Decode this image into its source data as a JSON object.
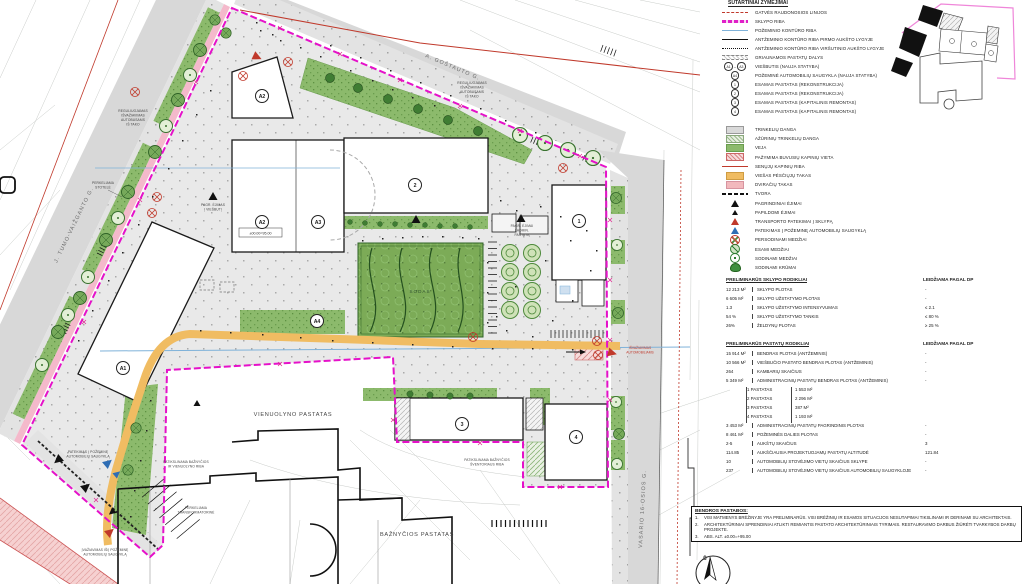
{
  "colors": {
    "site_boundary": "#e511c9",
    "street_red_line": "#c0392b",
    "underground_blue": "#7fb2d9",
    "lawn_green": "#8cba6c",
    "path_orange": "#f0bc62",
    "bike_pink": "#f4b9cb",
    "paving_gray": "#e3e3e3"
  },
  "plan": {
    "streets": {
      "gostauto": "A. GOŠTAUTO G.",
      "tumo_vaizganto": "J. TUMO-VAIŽGANTO G.",
      "vasario": "VASARIO 16-OSIOS G."
    },
    "areas": {
      "vienuolynas": "VIENUOLYNO PASTATAS",
      "baznycia": "BAŽNYČIOS PASTATAS",
      "sodas": "SODAS"
    },
    "elevation": "±00.00=95.00",
    "north": "Š",
    "badges": {
      "a1": "A1",
      "a2_upper": "A2",
      "a2": "A2",
      "a3": "A3",
      "a4": "A4",
      "b1": "1",
      "b2": "2",
      "b3": "3",
      "b4": "4"
    },
    "annotations": {
      "regul_top": [
        "REGULIUOJAMAS",
        "IŠVAŽIAVIMAS",
        "AUTOBUSAMS",
        "IŠ TAKO"
      ],
      "regul_left": [
        "REGULIUOJAMAS",
        "IŠVAŽIAVIMAS",
        "AUTOBUSAMS",
        "IŠ TAKO"
      ],
      "stotele": [
        "PERKELIAMA",
        "STOTELĖ"
      ],
      "pagr_viesbutis": [
        "PAGR. ĖJIMAS",
        "Į VIEŠBUTĮ"
      ],
      "pagr_admin": [
        "PAGR. ĖJIMAI",
        "Į ADMIN.",
        "PASTATĄ"
      ],
      "patekimas_pozemine": [
        "PATEKIMAS Į POŽEMINĘ",
        "AUTOMOBILIŲ SAUGYKLĄ"
      ],
      "isvaziavimas_pozemine": [
        "ĮVAŽIAVIMAS IŠ/Į POŽEMINĘ",
        "AUTOMOBILIŲ SAUGYKLĄ"
      ],
      "isvaziavimas_auto": [
        "IŠVAŽIAVIMAS",
        "AUTOMOBILIAMS"
      ],
      "patikslinama_riba": [
        "PATIKSLINAMA BAŽNYČIOS",
        "IR VIENUOLYNO RIBA"
      ],
      "transformatorine": [
        "PERKELIAMA",
        "TRANSFORMATORINĖ"
      ],
      "sventorius": [
        "PATIKSLINAMA BAŽNYČIOS",
        "ŠVENTORIAUS RIBA"
      ]
    }
  },
  "legend": {
    "title": "SUTARTINIAI ŽYMĖJIMAI",
    "lines": [
      {
        "sym": "line-red-dashed",
        "label": "GATVĖS RAUDONOSIOS LINIJOS"
      },
      {
        "sym": "line-magenta",
        "label": "SKLYPO RIBA"
      },
      {
        "sym": "line-blue",
        "label": "POŽEMINIO KONTŪRO RIBA"
      },
      {
        "sym": "line-black",
        "label": "ANTŽEMINIO KONTŪRO RIBA PIRMO AUKŠTO LYGYJE"
      },
      {
        "sym": "line-black-dotted",
        "label": "ANTŽEMINIO KONTŪRO RIBA VIRŠUTINIO AUKŠTO LYGYJE"
      },
      {
        "sym": "line-demolish",
        "label": "GRIAUNAMOS PASTATŲ DALYS"
      },
      {
        "sym": "badge-pair",
        "g1": "A1",
        "dash": "–",
        "g2": "A3",
        "label": "VIEŠBUTIS (NAUJA STATYBA)"
      },
      {
        "sym": "badge",
        "g1": "A4",
        "label": "POŽEMINĖ AUTOMOBILIŲ SAUGYKLA (NAUJA STATYBA)"
      },
      {
        "sym": "badge",
        "g1": "1",
        "label": "ESAMAS PASTATAS (REKONSTRUKCIJA)"
      },
      {
        "sym": "badge",
        "g1": "2",
        "label": "ESAMAS PASTATAS (REKONSTRUKCIJA)"
      },
      {
        "sym": "badge",
        "g1": "3",
        "label": "ESAMAS PASTATAS (KAPITALINIS REMONTAS)"
      },
      {
        "sym": "badge",
        "g1": "4",
        "label": "ESAMAS PASTATAS (KAPITALINIS REMONTAS)"
      }
    ],
    "surfaces": [
      {
        "sym": "swatch-gray",
        "label": "TRINKELIŲ DANGA"
      },
      {
        "sym": "swatch-perm",
        "label": "AŽŪRINIŲ TRINKELIŲ DANGA"
      },
      {
        "sym": "swatch-green",
        "label": "VEJA"
      },
      {
        "sym": "swatch-cemetery",
        "label": "PAŽYMIMA BUVUSIŲ KAPINIŲ VIETA"
      },
      {
        "sym": "line-red",
        "label": "SENŲJŲ KAPINIŲ RIBA"
      },
      {
        "sym": "swatch-orange",
        "label": "VIEŠAS PĖSČIŲJŲ TAKAS"
      },
      {
        "sym": "swatch-pink",
        "label": "DVIRAČIŲ TAKAS"
      },
      {
        "sym": "line-fence",
        "label": "TVORA"
      },
      {
        "sym": "tri-black",
        "label": "PAGRINDINIAI ĖJIMAI"
      },
      {
        "sym": "tri-black-small",
        "label": "PAPILDOMI ĖJIMAI"
      },
      {
        "sym": "tri-red",
        "label": "TRANSPORTO PATEKIMAI Į SKLYPĄ"
      },
      {
        "sym": "tri-blue",
        "label": "PATEKIMAS Į POŽEMINĘ AUTOMOBILIŲ SAUGYKLĄ"
      },
      {
        "sym": "tree-replant",
        "label": "PERSODINAMI MEDŽIAI"
      },
      {
        "sym": "tree-existing",
        "label": "ESAMI MEDŽIAI"
      },
      {
        "sym": "tree-new",
        "label": "SODINAMI MEDŽIAI"
      },
      {
        "sym": "shrub",
        "label": "SODINAMI KRŪMAI"
      }
    ]
  },
  "tables": {
    "site": {
      "title": "PRELIMINARŪS SKLYPO RODIKLIAI",
      "allowed_header": "LEIDŽIAMA PAGAL DP",
      "rows": [
        {
          "value": "12 213 M²",
          "label": "SKLYPO PLOTAS",
          "allowed": "-"
        },
        {
          "value": "6 605 M²",
          "label": "SKLYPO UŽSTATYMO PLOTAS",
          "allowed": "-"
        },
        {
          "value": "1.3",
          "label": "SKLYPO UŽSTATYMO INTENSYVUMAS",
          "allowed": "≤ 2.1"
        },
        {
          "value": "54 %",
          "label": "SKLYPO UŽSTATYMO TANKIS",
          "allowed": "≤ 80 %"
        },
        {
          "value": "26%",
          "label": "ŽELDYNŲ PLOTAS",
          "allowed": "≥ 25 %"
        }
      ]
    },
    "buildings": {
      "title": "PRELIMINARŪS PASTATŲ RODIKLIAI",
      "allowed_header": "LEIDŽIAMA PAGAL DP",
      "rows_top": [
        {
          "value": "15 914 M²",
          "label": "BENDRAS PLOTAS (ANTŽEMINIS)",
          "allowed": "-"
        },
        {
          "value": "10 566 M²",
          "label": "VIEŠBUČIO PASTATO BENDRAS PLOTAS (ANTŽEMINIS)",
          "allowed": "-"
        },
        {
          "value": "264",
          "label": "KAMBARIŲ SKAIČIUS",
          "allowed": "-"
        },
        {
          "value": "5 349 M²",
          "label": "ADMINISTRACINIŲ PASTATŲ BENDRAS PLOTAS (ANTŽEMINIS)",
          "allowed": "-"
        }
      ],
      "sub_rows": [
        {
          "label": "1 PASTATAS",
          "value": "1 553 M²"
        },
        {
          "label": "2 PASTATAS",
          "value": "2 296 M²"
        },
        {
          "label": "3 PASTATAS",
          "value": "387 M²"
        },
        {
          "label": "4 PASTATAS",
          "value": "1 193 M²"
        }
      ],
      "rows_bottom": [
        {
          "value": "3 453 M²",
          "label": "ADMINISTRACINIŲ PASTATŲ PAGRINDINIS PLOTAS",
          "allowed": "-"
        },
        {
          "value": "8 461 M²",
          "label": "POŽEMINĖS DALIES PLOTAS",
          "allowed": "-"
        },
        {
          "value": "2-5",
          "label": "AUKŠTŲ SKAIČIUS",
          "allowed": "3"
        },
        {
          "value": "114.85",
          "label": "AUKŠČIAUSIA PROJEKTUOJAMŲ PASTATŲ ALTITUDĖ",
          "allowed": "121.84"
        },
        {
          "value": "10",
          "label": "AUTOMOBILIŲ STOVĖJIMO VIETŲ SKAIČIUS SKLYPE",
          "allowed": "-"
        },
        {
          "value": "237",
          "label": "AUTOMOBILIŲ STOVĖJIMO VIETŲ SKAIČIUS AUTOMOBILIŲ SAUGYKLOJE",
          "allowed": "-"
        }
      ]
    }
  },
  "notes": {
    "title": "BENDROS PASTABOS:",
    "items": [
      {
        "n": "1.",
        "text": "VISI MATMENYS BRĖŽINYJE YRA PRELIMINARŪS. VISI BRĖŽINIŲ IR ESAMOS SITUACIJOS NESUTAPIMAI TIKSLINAMI IR DERINAMI SU ARCHITEKTAIS."
      },
      {
        "n": "2.",
        "text": "ARCHITEKTŪRINIAI SPRENDINIAI ATLIKTI REMIANTIS PASTATO ARCHITEKTŪRINIAIS TYRIMAIS. RESTAURAVIMO DARBUS ŽIŪRĖTI TVARKYBOS DARBŲ PROJEKTE."
      },
      {
        "n": "3.",
        "text": "ABS. ALT. ±0.00=+95.00"
      }
    ]
  }
}
